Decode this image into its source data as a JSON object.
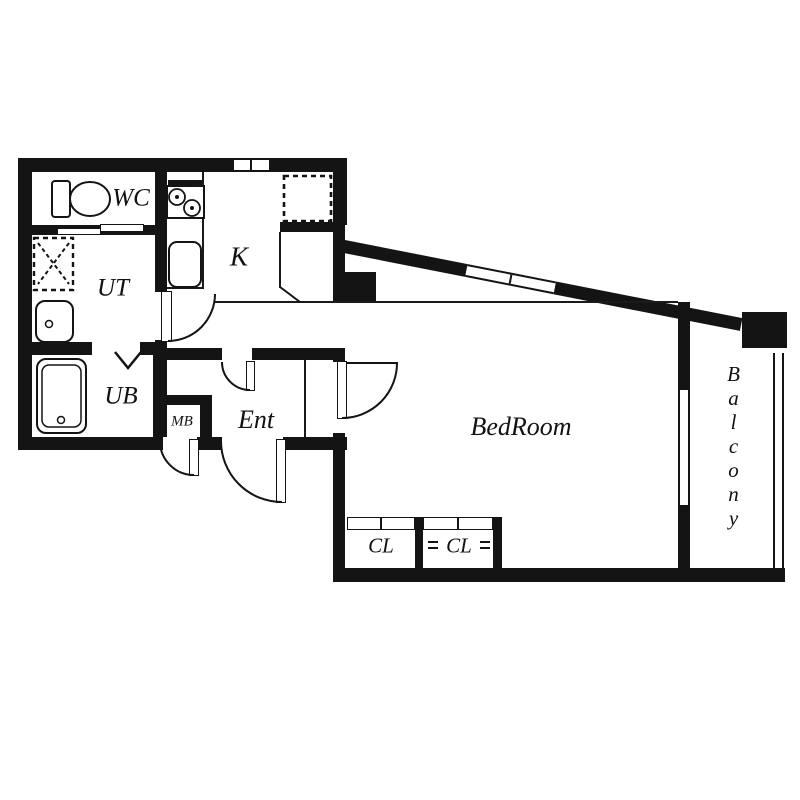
{
  "rooms": {
    "wc": "WC",
    "ut": "UT",
    "ub": "UB",
    "mb": "MB",
    "kitchen": "K",
    "entrance": "Ent",
    "bedroom": "BedRoom",
    "closet1": "CL",
    "closet2": "CL",
    "balcony": "Balcony"
  },
  "colors": {
    "wall": "#141414",
    "background": "#ffffff"
  }
}
